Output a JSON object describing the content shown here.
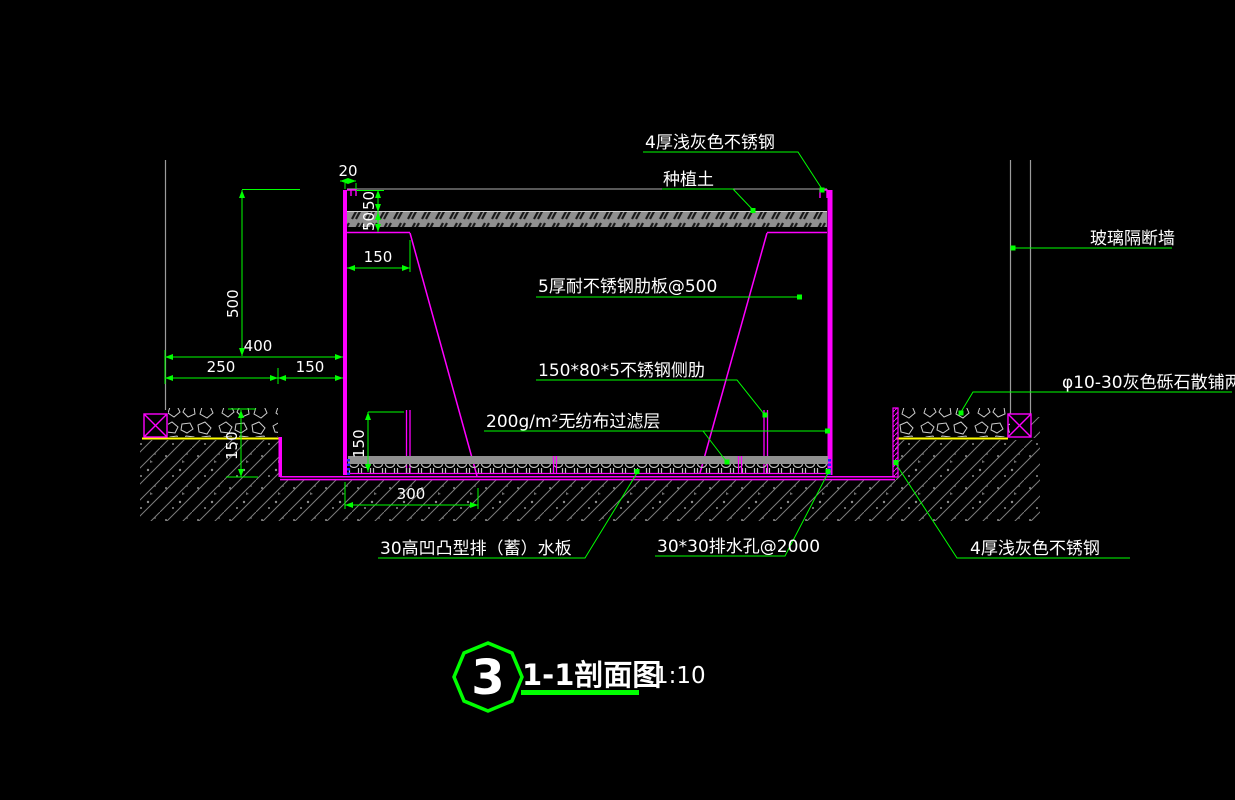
{
  "drawing": {
    "labels": {
      "top_steel": "4厚浅灰色不锈钢",
      "planting_soil": "种植土",
      "rib_plate": "5厚耐不锈钢肋板@500",
      "side_rib": "150*80*5不锈钢侧肋",
      "filter_layer": "200g/m²无纺布过滤层",
      "glass_partition": "玻璃隔断墙",
      "gravel_note": "φ10-30灰色砾石散铺两层",
      "drain_board": "30高凹凸型排（蓄）水板",
      "drain_holes": "30*30排水孔@2000",
      "bottom_steel": "4厚浅灰色不锈钢"
    },
    "dims": {
      "lip_width": "20",
      "soil_cover_top": "50",
      "soil_cover_bottom": "50",
      "rib_inset": "150",
      "wall_height": "500",
      "offset_total": "400",
      "offset_left": "250",
      "offset_right": "150",
      "gravel_depth": "150",
      "side_rib_height": "150",
      "base_span": "300"
    },
    "title_block": {
      "number": "3",
      "name": "1-1剖面图",
      "scale": "1:10"
    },
    "colors": {
      "background": "#000000",
      "structure": "#FF00FF",
      "annotation": "#00FF00",
      "text": "#FFFFFF",
      "reference": "#9C9C9C",
      "bedding": "#FFFF00",
      "drain_mark": "#2222FF"
    }
  }
}
